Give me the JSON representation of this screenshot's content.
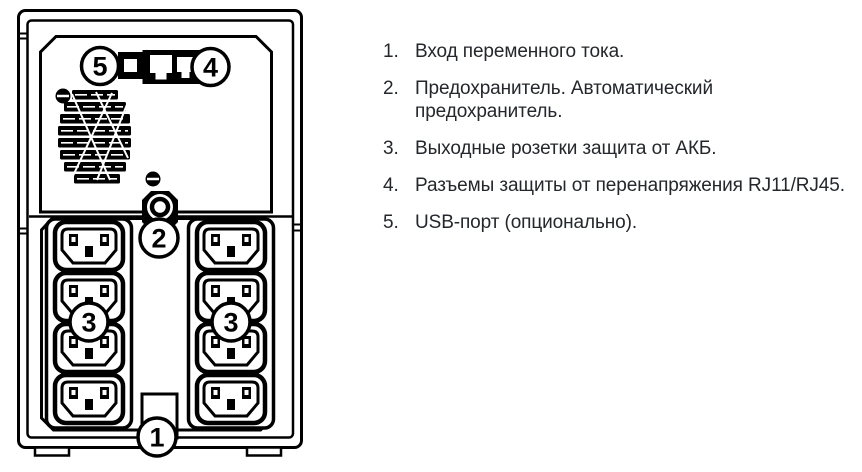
{
  "device": {
    "type": "ups-rear-panel-diagram",
    "callouts": {
      "ac_input": "1",
      "fuse": "2",
      "outlets_left": "3",
      "outlets_right": "3",
      "rj_protection": "4",
      "usb_port": "5"
    }
  },
  "legend": {
    "items": [
      {
        "num": "1.",
        "text": "Вход переменного тока."
      },
      {
        "num": "2.",
        "text": "Предохранитель. Автоматический\nпредохранитель."
      },
      {
        "num": "3.",
        "text": "Выходные розетки защита от АКБ."
      },
      {
        "num": "4.",
        "text": "Разъемы защиты от перенапряжения RJ11/RJ45."
      },
      {
        "num": "5.",
        "text": "USB-порт (опционально)."
      }
    ]
  },
  "colors": {
    "line": "#000000",
    "text": "#24272b",
    "background": "#ffffff"
  }
}
